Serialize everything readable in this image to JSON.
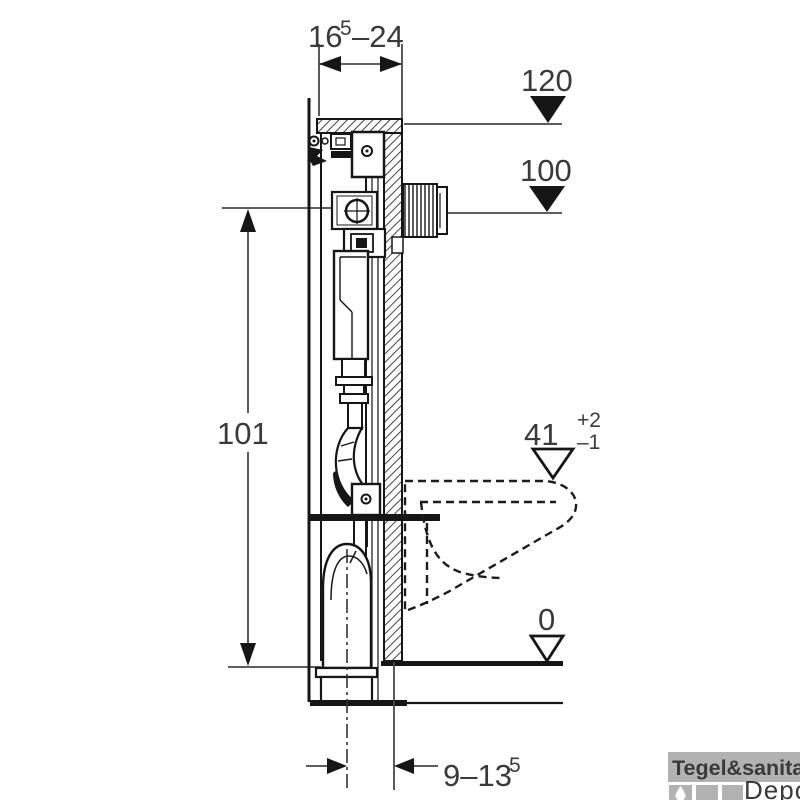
{
  "diagram": {
    "type": "technical-installation-drawing",
    "dimensions": {
      "top_width": {
        "value": "16",
        "sup": "5",
        "range": "–24"
      },
      "flush_level": "120",
      "supply_level": "100",
      "frame_height": "101",
      "bowl_height": {
        "value": "41",
        "tol_plus": "+2",
        "tol_minus": "–1"
      },
      "floor_level": "0",
      "outlet_offset": {
        "value": "9–13",
        "sup": "5"
      }
    },
    "colors": {
      "line": "#161616",
      "dimension_line": "#474747",
      "background": "#ffffff"
    }
  },
  "watermark": {
    "brand": "Tegel&sanitair",
    "sub_brand": "Depot",
    "bar_color": "#b2b2b2",
    "tile_color": "#b2b2b2",
    "brand_text_color": "#ffffff",
    "sub_text_color": "#c8c8c8"
  }
}
